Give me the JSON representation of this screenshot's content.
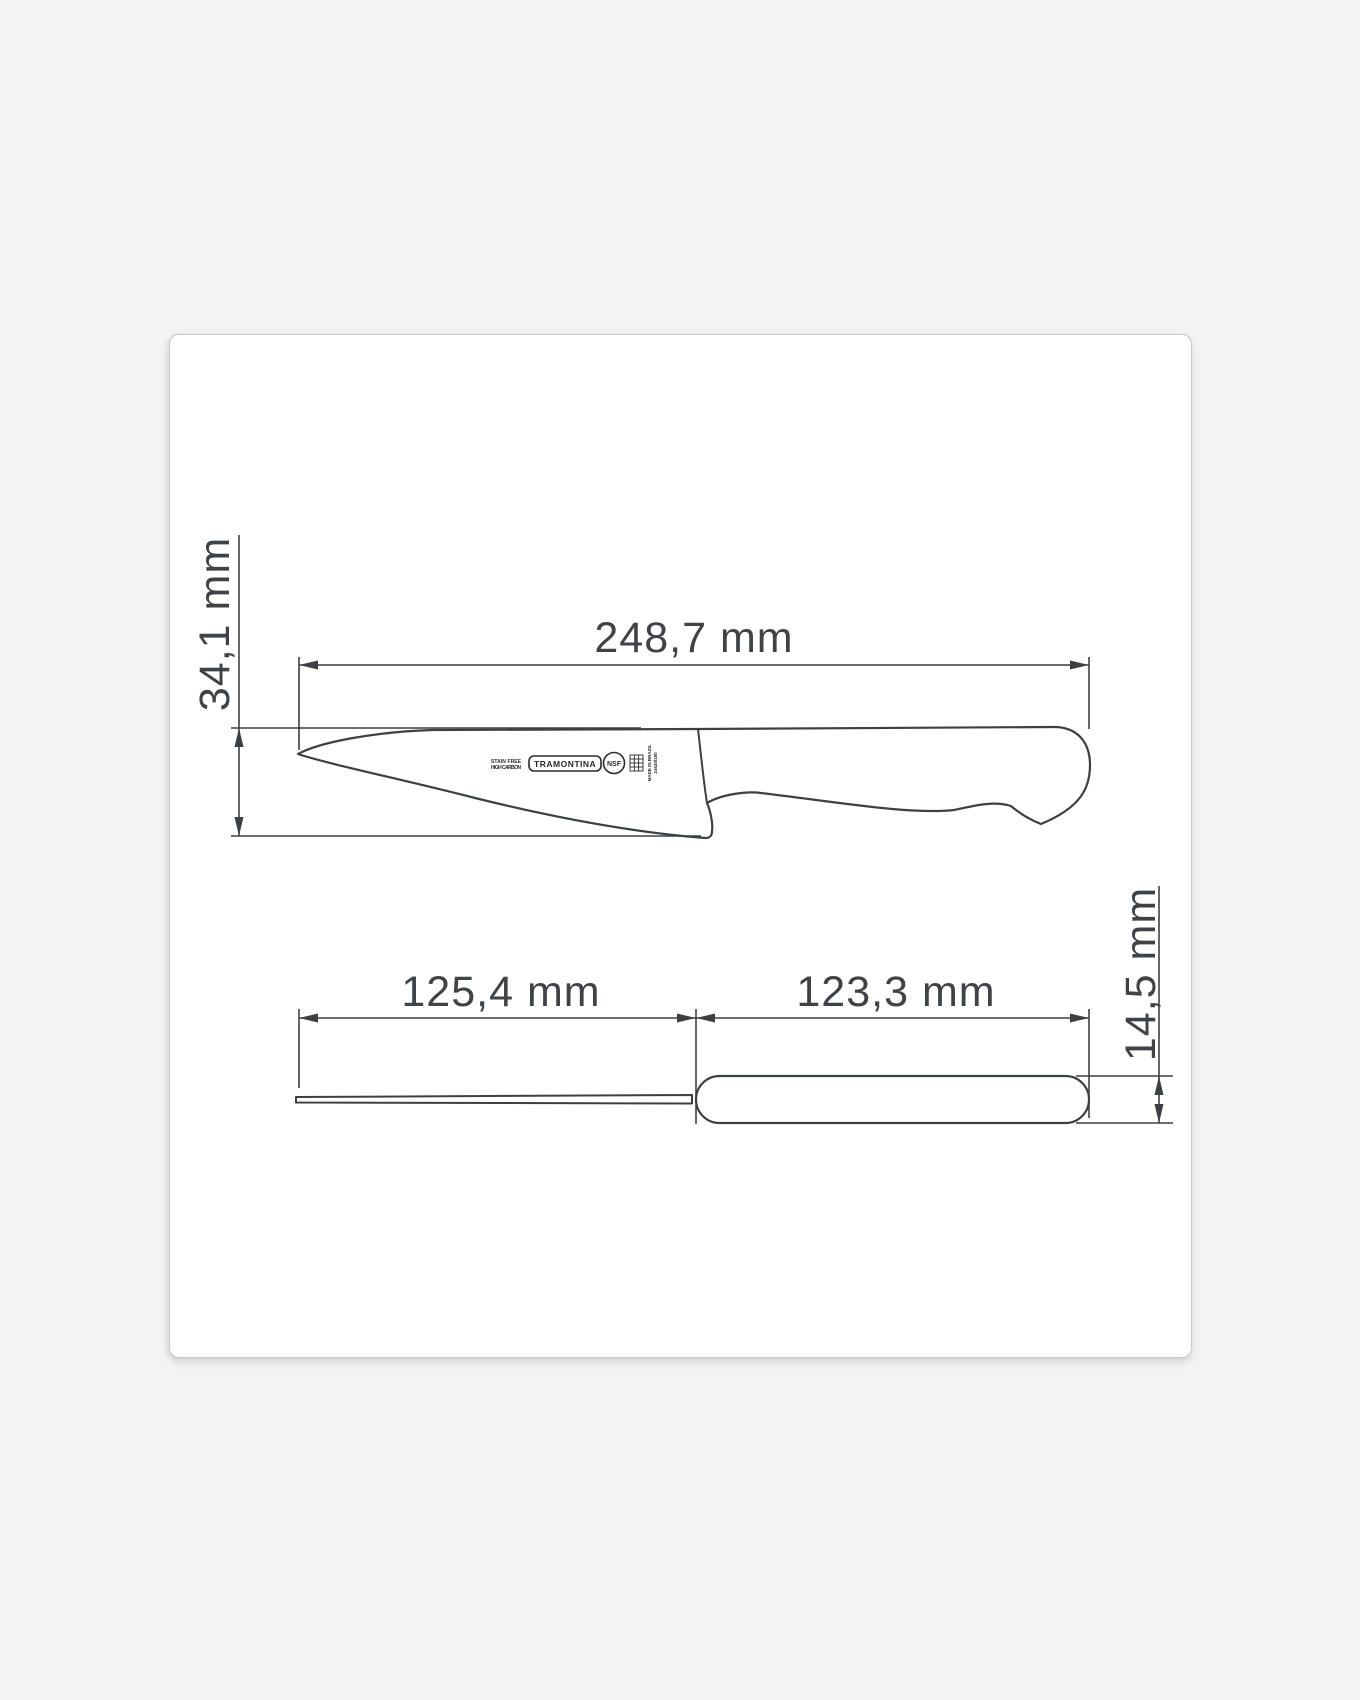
{
  "canvas": {
    "background": "#f3f3f4",
    "card_background": "#ffffff",
    "line_color": "#3d4043",
    "text_color": "#3f4347"
  },
  "dimensions": {
    "total_length": "248,7 mm",
    "blade_height": "34,1 mm",
    "blade_length": "125,4 mm",
    "handle_length": "123,3 mm",
    "handle_thickness": "14,5 mm"
  },
  "blade_markings": {
    "material_line1": "STAIN FREE",
    "material_line2": "HIGH CARBON",
    "brand": "TRAMONTINA",
    "certification": "NSF",
    "origin_line1": "MADE IN BRAZIL",
    "origin_line2": "24620/180"
  }
}
